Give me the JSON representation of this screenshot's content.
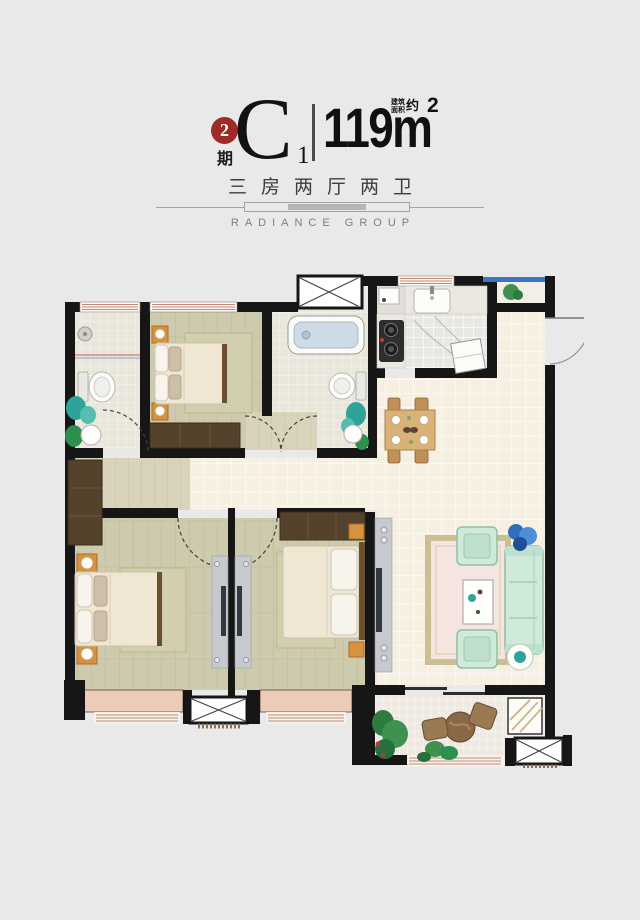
{
  "page": {
    "background": "#e9e9e9"
  },
  "header": {
    "phase_badge": {
      "number": "2",
      "suffix": "期",
      "color": "#9e2b26"
    },
    "unit": {
      "letter": "C",
      "index": "1"
    },
    "area": {
      "prefix_line1": "建筑",
      "prefix_line2": "面积",
      "prefix_approx": "约",
      "value": "119m",
      "superscript": "2"
    },
    "layout_text": "三房两厅两卫",
    "brand": "RADIANCE GROUP"
  },
  "floorplan": {
    "colors": {
      "wall": "#161616",
      "wood_bedroom": "#cecaad",
      "wood_hall": "#d9d3bb",
      "tile_main": "#f6f0e2",
      "tile_bath": "#e9e6dc",
      "tile_balcony": "#eee9e2",
      "kitchen_floor": "#dfdeda",
      "counter": "#eae8e1",
      "bay_fill": "#ecccb8",
      "window_stripe": "#c28876",
      "railing_blue": "#3f74c2",
      "wardrobe_wood": "#55422c",
      "nightstand_orange": "#d6923f",
      "bed_cream": "#efe7d4",
      "pillow_white": "#f7f4ec",
      "rug_bedroom": "#d2cfae",
      "rug_living_center": "#f5e5e1",
      "rug_living_border": "#cbbe92",
      "sofa_mint": "#cfead9",
      "sofa_edge": "#8fbfa4",
      "plant_green": "#2f8f4f",
      "plant_teal": "#2fa39a",
      "plant_blue": "#2e6fbd",
      "tv_cabinet_gray": "#c6c9cd",
      "tv_dark": "#33383e",
      "tub_inner_blue": "#ccdbe6",
      "table_wood": "#d9b277",
      "chair_wood": "#c09058",
      "balcony_chair_wood": "#9a7a52",
      "shaft_fill": "#ffffff",
      "door_arc": "#8a8a8a"
    }
  }
}
